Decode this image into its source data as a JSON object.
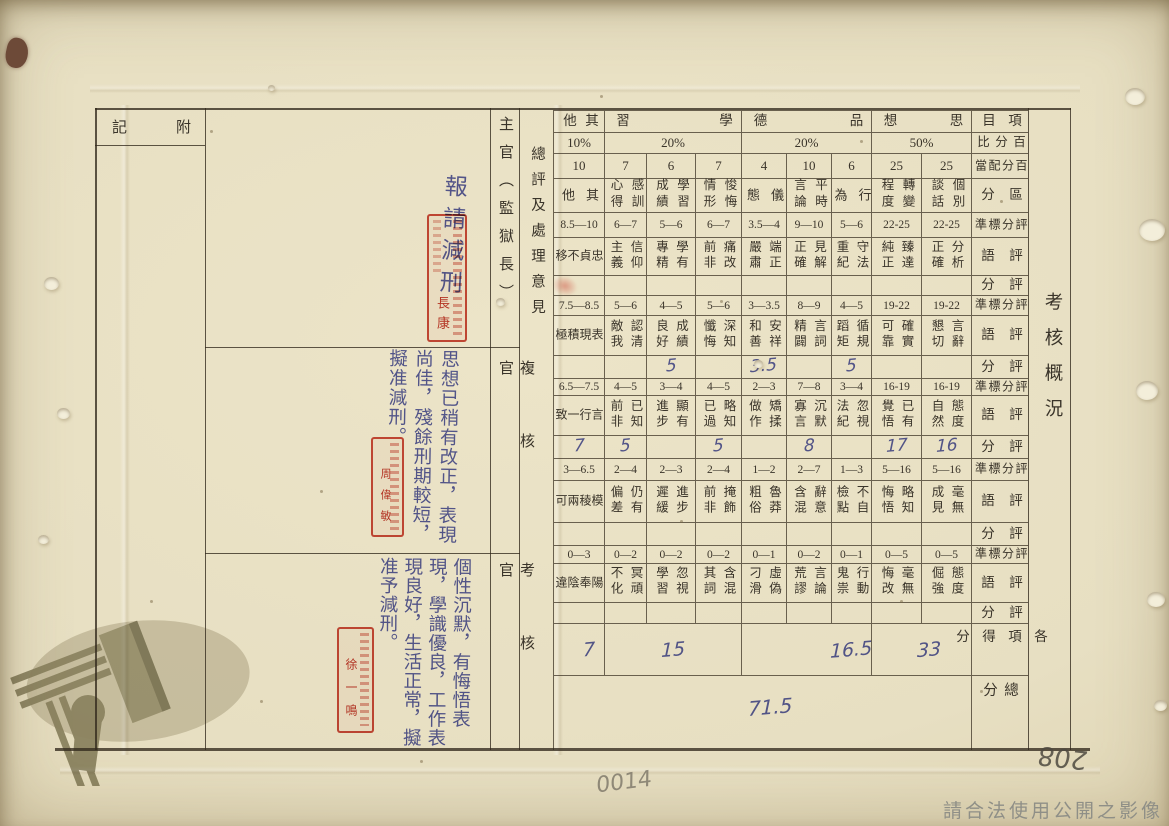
{
  "document": {
    "title_vertical": "考核概況",
    "archive_watermark_text": "請合法使用公開之影像",
    "pencil_number": "0014",
    "page_number": "208"
  },
  "left_panel": {
    "appendix_label": "附記",
    "overall_opinion_label": "總評及處理意見",
    "sections": [
      {
        "officer": "主官（監獄長）",
        "comment": "報請減刑",
        "seal_text": "長康"
      },
      {
        "officer": "複核官",
        "comment": "思想已稍有改正，表現尚佳，殘餘刑期較短，擬准減刑。",
        "seal_text": "周偉敏"
      },
      {
        "officer": "考核官",
        "comment": "個性沉默，有悔悟表現，學識優良，工作表現良好，生活正常，擬准予減刑。",
        "seal_text": "徐一鳴"
      }
    ]
  },
  "table": {
    "corner_label": "項目",
    "row_labels": {
      "percent": "百分比",
      "allocation": "百分配當",
      "category": "區分",
      "standard": "評分標準",
      "remark": "評語",
      "score": "評分",
      "subtotal": "各項得分",
      "total": "總分"
    },
    "groups": [
      {
        "label": "其他",
        "percent": "10%",
        "cols": 1
      },
      {
        "label": "學習",
        "percent": "20%",
        "cols": 3
      },
      {
        "label": "品德",
        "percent": "20%",
        "cols": 3
      },
      {
        "label": "思想",
        "percent": "50%",
        "cols": 2
      }
    ],
    "columns": [
      {
        "category": "其他",
        "alloc": "10",
        "bands": [
          {
            "range": "8.5—10",
            "phrase": "忠貞不移",
            "score": ""
          },
          {
            "range": "7.5—8.5",
            "phrase": "表現積極",
            "score": ""
          },
          {
            "range": "6.5—7.5",
            "phrase": "言行一致",
            "score": "7"
          },
          {
            "range": "3—6.5",
            "phrase": "模稜兩可",
            "score": ""
          },
          {
            "range": "0—3",
            "phrase": "陽奉陰違",
            "score": ""
          }
        ]
      },
      {
        "category": "感訓心得",
        "alloc": "7",
        "bands": [
          {
            "range": "6—7",
            "phrase": "信仰主義",
            "score": ""
          },
          {
            "range": "5—6",
            "phrase": "認清敵我",
            "score": ""
          },
          {
            "range": "4—5",
            "phrase": "已知前非",
            "score": "5"
          },
          {
            "range": "2—4",
            "phrase": "仍有偏差",
            "score": ""
          },
          {
            "range": "0—2",
            "phrase": "冥頑不化",
            "score": ""
          }
        ]
      },
      {
        "category": "學習成績",
        "alloc": "6",
        "bands": [
          {
            "range": "5—6",
            "phrase": "學有專精",
            "score": ""
          },
          {
            "range": "4—5",
            "phrase": "成績良好",
            "score": "5"
          },
          {
            "range": "3—4",
            "phrase": "顯有進步",
            "score": ""
          },
          {
            "range": "2—3",
            "phrase": "進步遲緩",
            "score": ""
          },
          {
            "range": "0—2",
            "phrase": "忽視學習",
            "score": ""
          }
        ]
      },
      {
        "category": "悛悔情形",
        "alloc": "7",
        "bands": [
          {
            "range": "6—7",
            "phrase": "痛改前非",
            "score": ""
          },
          {
            "range": "5—6",
            "phrase": "深知懺悔",
            "score": ""
          },
          {
            "range": "4—5",
            "phrase": "略知已過",
            "score": "5"
          },
          {
            "range": "2—4",
            "phrase": "掩飾前非",
            "score": ""
          },
          {
            "range": "0—2",
            "phrase": "含混其詞",
            "score": ""
          }
        ]
      },
      {
        "category": "儀態",
        "alloc": "4",
        "bands": [
          {
            "range": "3.5—4",
            "phrase": "端正嚴肅",
            "score": ""
          },
          {
            "range": "3—3.5",
            "phrase": "安祥和善",
            "score": "3.5"
          },
          {
            "range": "2—3",
            "phrase": "矯揉做作",
            "score": ""
          },
          {
            "range": "1—2",
            "phrase": "魯莽粗俗",
            "score": ""
          },
          {
            "range": "0—1",
            "phrase": "虛偽刁滑",
            "score": ""
          }
        ]
      },
      {
        "category": "平時言論",
        "alloc": "10",
        "bands": [
          {
            "range": "9—10",
            "phrase": "見解正確",
            "score": ""
          },
          {
            "range": "8—9",
            "phrase": "言詞精闢",
            "score": ""
          },
          {
            "range": "7—8",
            "phrase": "沉默寡言",
            "score": "8"
          },
          {
            "range": "2—7",
            "phrase": "辭意含混",
            "score": ""
          },
          {
            "range": "0—2",
            "phrase": "言論荒謬",
            "score": ""
          }
        ]
      },
      {
        "category": "行為",
        "alloc": "6",
        "bands": [
          {
            "range": "5—6",
            "phrase": "守法重紀",
            "score": ""
          },
          {
            "range": "4—5",
            "phrase": "循規蹈矩",
            "score": "5"
          },
          {
            "range": "3—4",
            "phrase": "忽視法紀",
            "score": ""
          },
          {
            "range": "1—3",
            "phrase": "不自檢點",
            "score": ""
          },
          {
            "range": "0—1",
            "phrase": "行動鬼祟",
            "score": ""
          }
        ]
      },
      {
        "category": "轉變程度",
        "alloc": "25",
        "bands": [
          {
            "range": "22-25",
            "phrase": "臻達純正",
            "score": ""
          },
          {
            "range": "19-22",
            "phrase": "確實可靠",
            "score": ""
          },
          {
            "range": "16-19",
            "phrase": "已有覺悟",
            "score": "17"
          },
          {
            "range": "5—16",
            "phrase": "略知悔悟",
            "score": ""
          },
          {
            "range": "0—5",
            "phrase": "毫無悔改",
            "score": ""
          }
        ]
      },
      {
        "category": "個別談話",
        "alloc": "25",
        "bands": [
          {
            "range": "22-25",
            "phrase": "分析正確",
            "score": ""
          },
          {
            "range": "19-22",
            "phrase": "言辭懇切",
            "score": ""
          },
          {
            "range": "16-19",
            "phrase": "態度自然",
            "score": "16"
          },
          {
            "range": "5—16",
            "phrase": "毫無成見",
            "score": ""
          },
          {
            "range": "0—5",
            "phrase": "態度倔強",
            "score": ""
          }
        ]
      }
    ],
    "subtotals": [
      {
        "group": "其他",
        "value": "7"
      },
      {
        "group": "學習",
        "value": "15"
      },
      {
        "group": "品德",
        "value": "16.5"
      },
      {
        "group": "思想",
        "value": "33"
      }
    ],
    "total_score": "71.5"
  }
}
